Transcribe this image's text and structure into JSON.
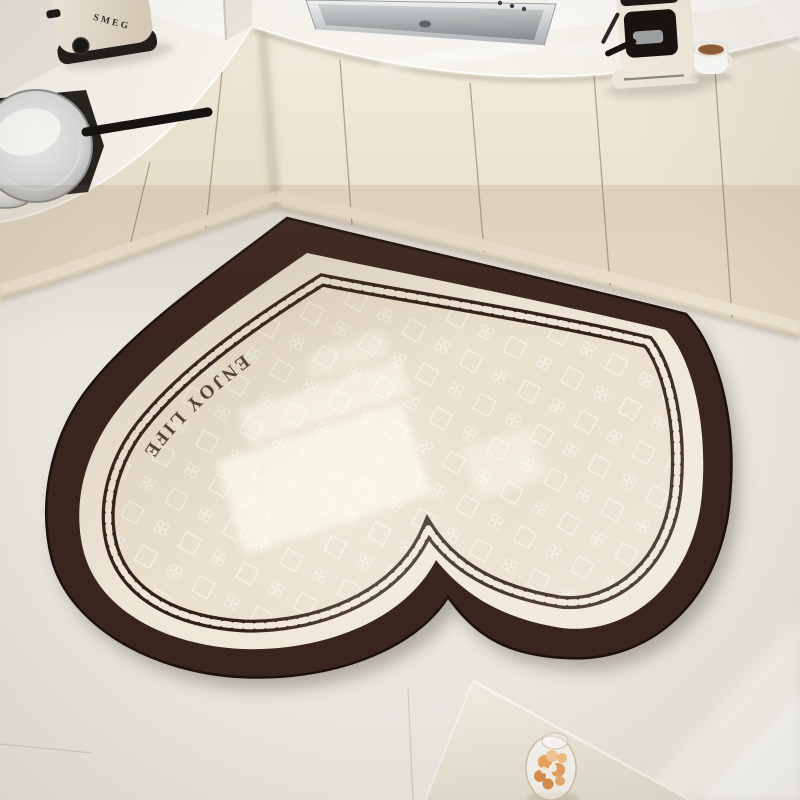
{
  "mat": {
    "text": "ENJOY LIFE",
    "colors": {
      "band": "#3A241E",
      "margin": "#EFE7D8",
      "field": "#E9E0CE",
      "chain": "#33201A",
      "text_color": "#4B342C"
    }
  },
  "toaster": {
    "brand": "SMEG"
  },
  "palette": {
    "floor": "#E9E6E0",
    "cabinets": "#EFE8D8",
    "countertop": "#F5F3ED",
    "wall": "#FBFAF8",
    "table": "#E9E5D9",
    "flowers": "#E2A15E",
    "sink_steel": "#C2C6C7"
  },
  "objects": [
    "heart-shaped kitchen floor mat",
    "chain-link border",
    "stainless steel sink",
    "SMEG toaster",
    "espresso machine",
    "white coffee cup",
    "gas stove with wok pan",
    "white dining table corner",
    "glass vase with peach dried flowers",
    "window light reflections"
  ]
}
